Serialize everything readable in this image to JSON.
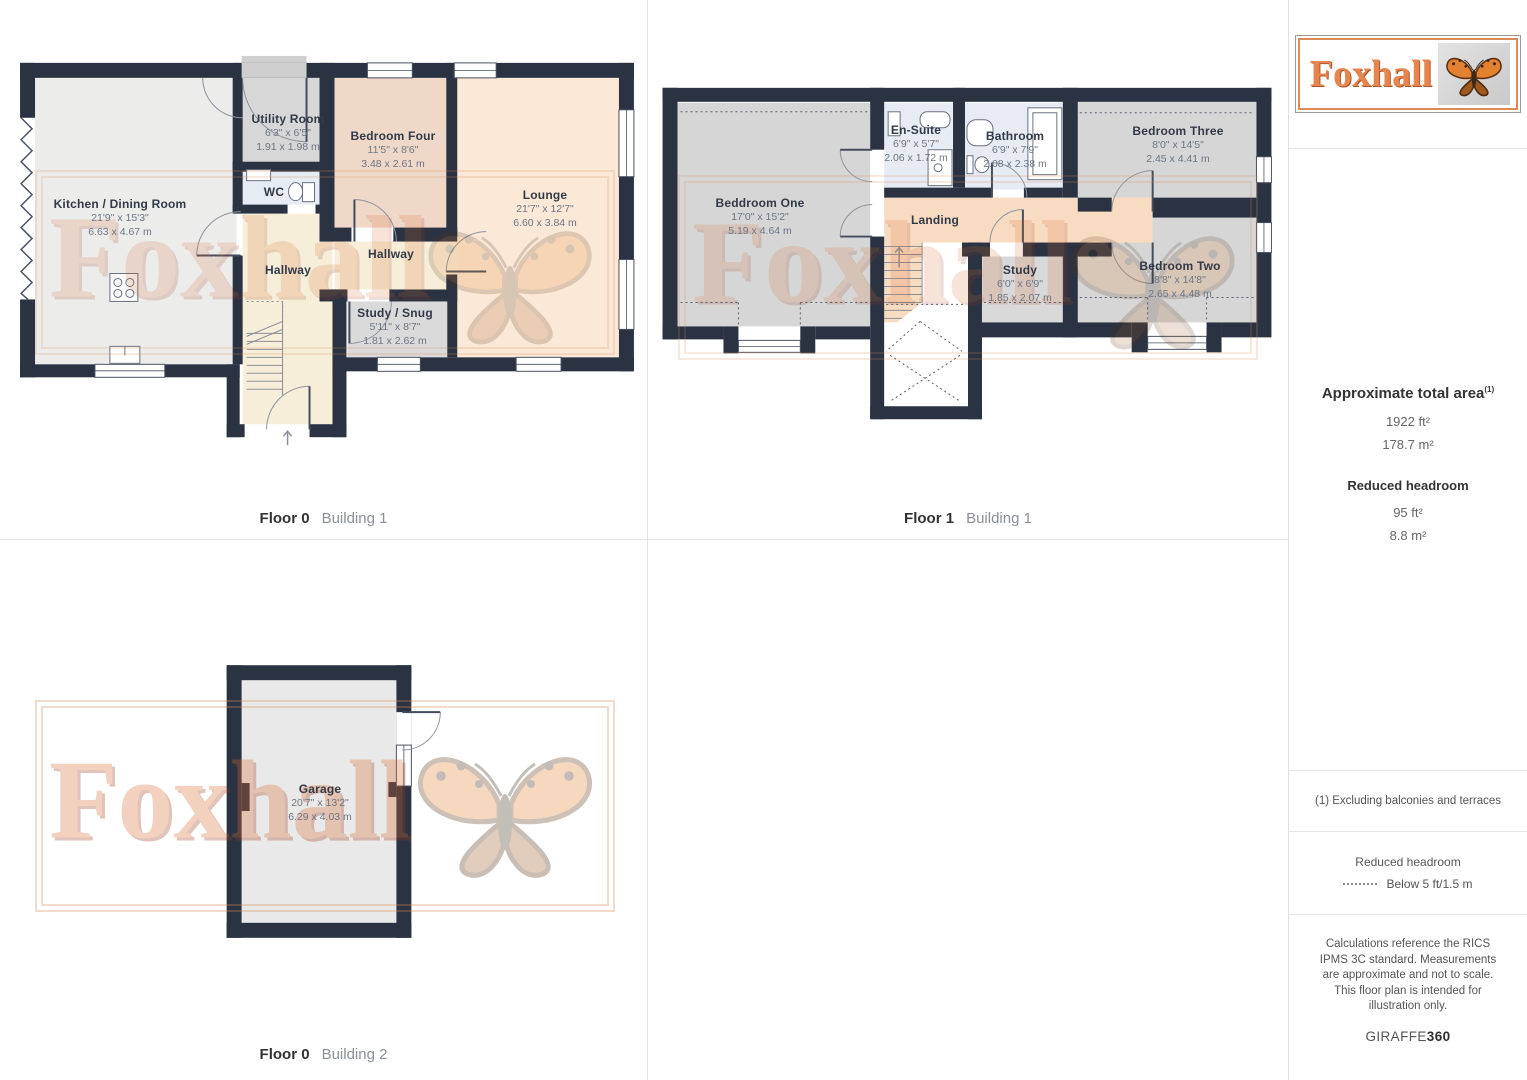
{
  "watermark": {
    "text": "Foxhall"
  },
  "colors": {
    "wall": "#2b3342",
    "hallway": "#f6eed9",
    "landing": "#f8dcc2",
    "bathroom": "#e7ebf4",
    "bedroom_warm": "#f0d8c9",
    "lounge": "#fbe8d6",
    "gray_room": "#d9d9d9",
    "watermark_orange": "#d96a2f",
    "logo_orange": "#e8854f"
  },
  "plans": {
    "f0b1": {
      "floor": "Floor 0",
      "building": "Building 1",
      "rooms": {
        "kitchen": {
          "name": "Kitchen / Dining Room",
          "imp": "21'9\" x 15'3\"",
          "met": "6.63 x 4.67 m"
        },
        "utility": {
          "name": "Utility Room",
          "imp": "6'3\" x 6'5\"",
          "met": "1.91 x 1.98 m"
        },
        "wc": {
          "name": "WC"
        },
        "bed4": {
          "name": "Bedroom Four",
          "imp": "11'5\" x 8'6\"",
          "met": "3.48 x 2.61 m"
        },
        "lounge": {
          "name": "Lounge",
          "imp": "21'7\" x 12'7\"",
          "met": "6.60 x 3.84 m"
        },
        "hall1": {
          "name": "Hallway"
        },
        "hall2": {
          "name": "Hallway"
        },
        "study": {
          "name": "Study / Snug",
          "imp": "5'11\" x 8'7\"",
          "met": "1.81 x 2.62 m"
        }
      }
    },
    "f1b1": {
      "floor": "Floor 1",
      "building": "Building 1",
      "rooms": {
        "bed1": {
          "name": "Beddroom One",
          "imp": "17'0\" x 15'2\"",
          "met": "5.19 x 4.64 m"
        },
        "ensuite": {
          "name": "En-Suite",
          "imp": "6'9\" x 5'7\"",
          "met": "2.06 x 1.72 m"
        },
        "bath": {
          "name": "Bathroom",
          "imp": "6'9\" x 7'9\"",
          "met": "2.08 x 2.38 m"
        },
        "bed3": {
          "name": "Bedroom Three",
          "imp": "8'0\" x 14'5\"",
          "met": "2.45 x 4.41 m"
        },
        "landing": {
          "name": "Landing"
        },
        "study": {
          "name": "Study",
          "imp": "6'0\" x 6'9\"",
          "met": "1.85 x 2.07 m"
        },
        "bed2": {
          "name": "Bedroom Two",
          "imp": "8'8\" x 14'8\"",
          "met": "2.65 x 4.48 m"
        }
      }
    },
    "f0b2": {
      "floor": "Floor 0",
      "building": "Building 2",
      "rooms": {
        "garage": {
          "name": "Garage",
          "imp": "20'7\" x 13'2\"",
          "met": "6.29 x 4.03 m"
        }
      }
    }
  },
  "sidebar": {
    "logo_text": "Foxhall",
    "total_area_label": "Approximate total area",
    "total_area_sup": "(1)",
    "total_area_ft": "1922 ft²",
    "total_area_m": "178.7 m²",
    "reduced_label": "Reduced headroom",
    "reduced_ft": "95 ft²",
    "reduced_m": "8.8 m²",
    "footnote": "(1) Excluding balconies and terraces",
    "legend_title": "Reduced headroom",
    "legend_value": "Below 5 ft/1.5 m",
    "disclaimer": "Calculations reference the RICS IPMS 3C standard. Measurements are approximate and not to scale. This floor plan is intended for illustration only.",
    "brand_giraffe": "GIRAFFE",
    "brand_360": "360"
  }
}
